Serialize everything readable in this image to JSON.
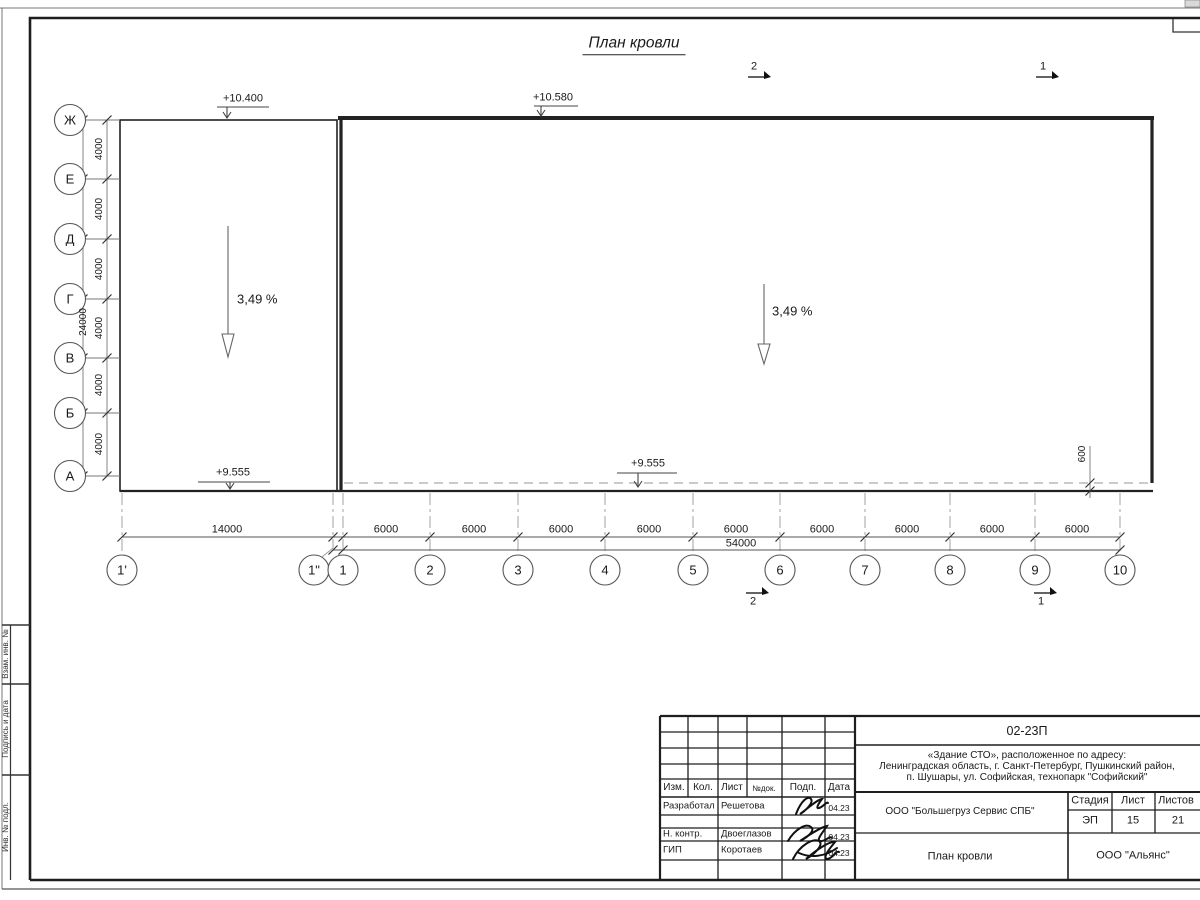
{
  "drawing": {
    "title": "План кровли",
    "slope_left": "3,49 %",
    "slope_right": "3,49 %",
    "elev_top_left": "+10.400",
    "elev_top_right": "+10.580",
    "elev_bottom_left": "+9.555",
    "elev_bottom_mid": "+9.555",
    "offset_dim": "600",
    "section_marks": [
      "2",
      "1"
    ]
  },
  "axes": {
    "letters": [
      "Ж",
      "Е",
      "Д",
      "Г",
      "В",
      "Б",
      "А"
    ],
    "letter_dims": [
      "4000",
      "4000",
      "4000",
      "4000",
      "4000",
      "4000"
    ],
    "letter_total": "24000",
    "numbers": [
      "1'",
      "1\"",
      "1",
      "2",
      "3",
      "4",
      "5",
      "6",
      "7",
      "8",
      "9",
      "10"
    ],
    "span_first": "14000",
    "bay_dims": [
      "6000",
      "6000",
      "6000",
      "6000",
      "6000",
      "6000",
      "6000",
      "6000",
      "6000"
    ],
    "total": "54000"
  },
  "titleblock": {
    "code": "02-23П",
    "address_line1": "«Здание СТО», расположенное по адресу:",
    "address_line2": "Ленинградская область, г. Санкт-Петербург, Пушкинский район,",
    "address_line3": "п. Шушары, ул. Софийская, технопарк \"Софийский\"",
    "col_izm": "Изм.",
    "col_kol": "Кол.",
    "col_list": "Лист",
    "col_ndok": "№док.",
    "col_podp": "Подп.",
    "col_data": "Дата",
    "rows": [
      {
        "role": "Разработал",
        "name": "Решетова",
        "date": "04.23"
      },
      {
        "role": "Н. контр.",
        "name": "Двоеглазов",
        "date": "04.23"
      },
      {
        "role": "ГИП",
        "name": "Коротаев",
        "date": "04.23"
      }
    ],
    "company": "ООО \"Большегруз Сервис СПБ\"",
    "stage_label": "Стадия",
    "sheet_label": "Лист",
    "sheets_label": "Листов",
    "stage": "ЭП",
    "sheet_num": "15",
    "sheets_total": "21",
    "doc_title": "План кровли",
    "org": "ООО \"Альянс\""
  },
  "frame": {
    "side_labels": [
      "Взам. инв. №",
      "Подпись и дата",
      "Инв. № подл."
    ]
  }
}
